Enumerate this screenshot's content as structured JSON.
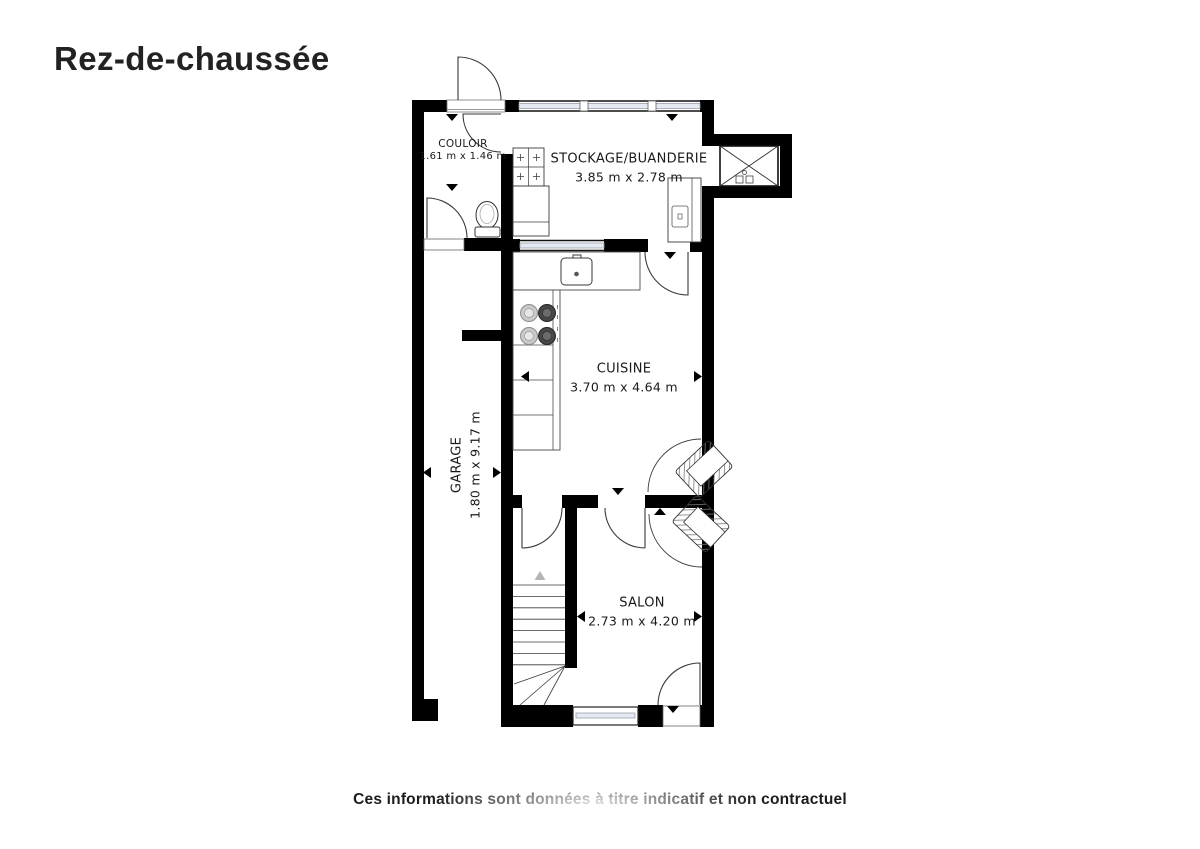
{
  "page": {
    "title": "Rez-de-chaussée",
    "disclaimer": "Ces informations sont données à titre indicatif et non contractuel"
  },
  "rooms": {
    "couloir": {
      "name": "COULOIR",
      "dims": "1.61 m x 1.46 m"
    },
    "stockage": {
      "name": "STOCKAGE/BUANDERIE",
      "dims": "3.85 m x 2.78 m"
    },
    "cuisine": {
      "name": "CUISINE",
      "dims": "3.70 m x 4.64 m"
    },
    "garage": {
      "name": "GARAGE",
      "dims": "1.80 m x 9.17 m"
    },
    "salon": {
      "name": "SALON",
      "dims": "2.73 m x 4.20 m"
    }
  },
  "symbols": [
    "toilet-icon",
    "sink-icon",
    "stove-icon",
    "washer-grid-icon",
    "cabinet-icon",
    "armchair-icon",
    "staircase-icon",
    "shaft-cross-icon",
    "door-swing-icon",
    "window-icon"
  ],
  "colors": {
    "wall": "#000000",
    "line": "#3a3a3a",
    "glass": "#e4e9f2",
    "floor": "#ffffff",
    "text": "#1a1a1a"
  }
}
